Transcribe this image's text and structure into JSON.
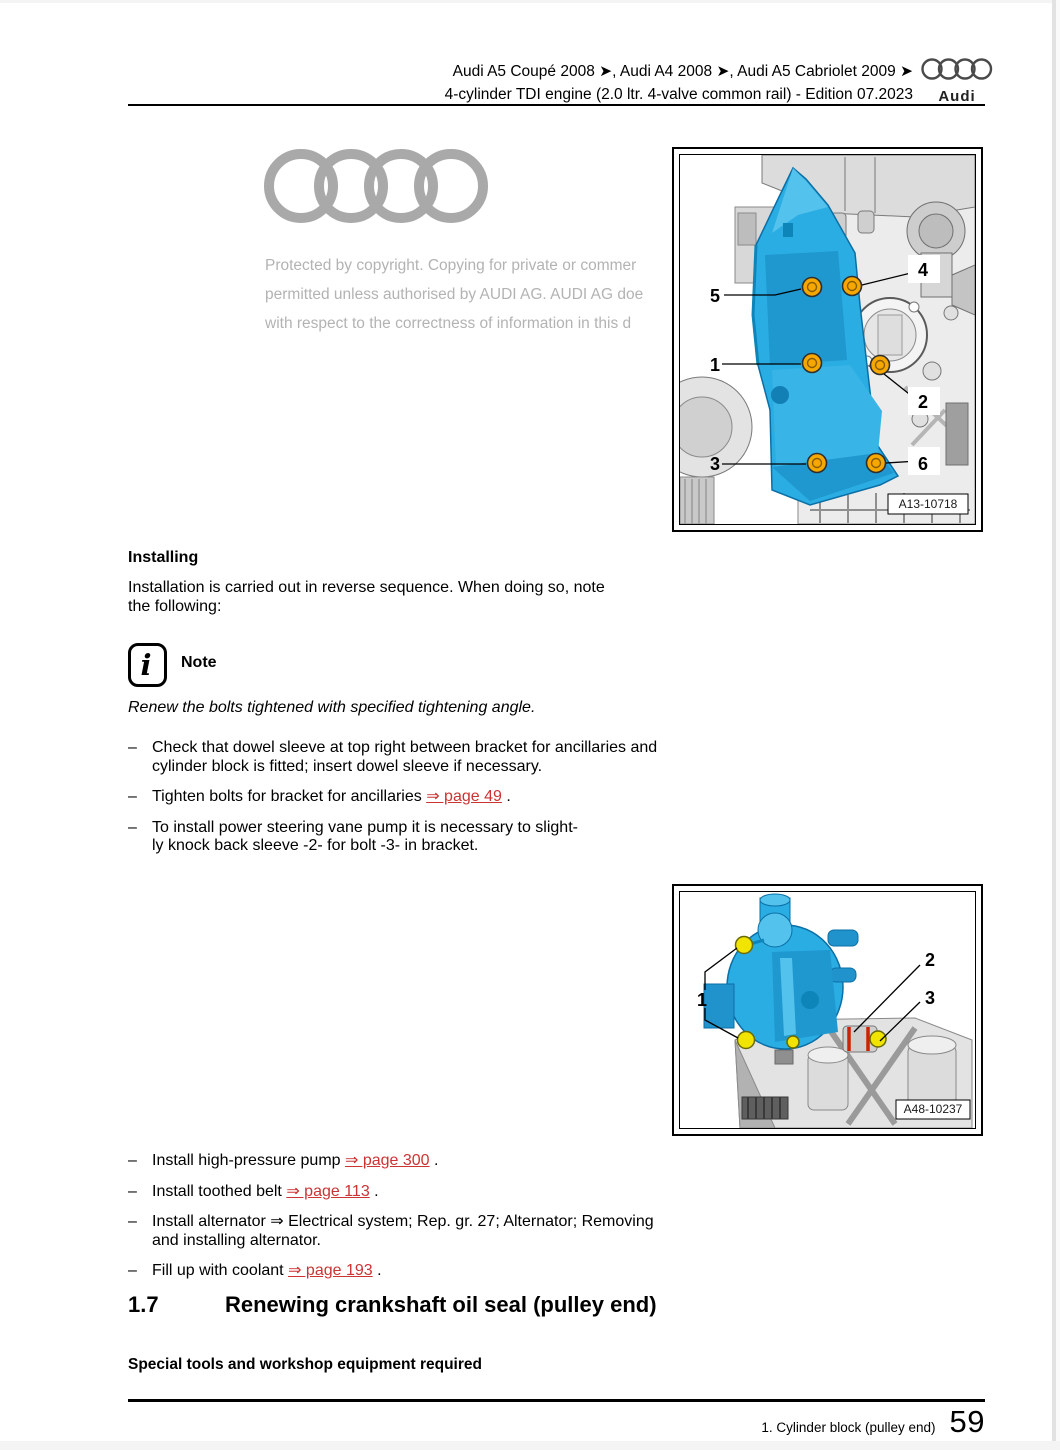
{
  "header": {
    "line1": "Audi A5 Coupé 2008 ➤, Audi A4 2008 ➤, Audi A5 Cabriolet 2009 ➤",
    "line2": "4-cylinder TDI engine (2.0 ltr. 4-valve common rail) - Edition 07.2023",
    "logo_wordmark": "Audi"
  },
  "watermark": {
    "line1": "Protected by copyright. Copying for private or commer",
    "line2": "permitted unless authorised by AUDI AG. AUDI AG doe",
    "line3": "with respect to the correctness of information in this d"
  },
  "figures": [
    {
      "id": "A13-10718",
      "callouts": [
        "1",
        "2",
        "3",
        "4",
        "5",
        "6"
      ]
    },
    {
      "id": "A48-10237",
      "callouts": [
        "1",
        "2",
        "3"
      ]
    }
  ],
  "glyphs": {
    "bullet": "–"
  },
  "content": {
    "installing_heading": "Installing",
    "installing_para": "Installation is carried out in reverse sequence. When doing so, note the following:",
    "note_icon_glyph": "i",
    "note_label": "Note",
    "note_italic": "Renew the bolts tightened with specified tightening angle.",
    "list1": [
      {
        "text": "Check that dowel sleeve at top right between bracket for ancillaries and cylinder block is fitted; insert dowel sleeve if necessary."
      },
      {
        "prefix": "Tighten bolts for bracket for ancillaries ",
        "link": "⇒ page 49",
        "suffix": " ."
      },
      {
        "line1": "To install power steering vane pump it is necessary to slight-",
        "line2": "ly knock back sleeve -2- for bolt -3- in bracket."
      }
    ],
    "list2": [
      {
        "prefix": "Install high-pressure pump ",
        "link": "⇒ page 300",
        "suffix": " ."
      },
      {
        "prefix": "Install toothed belt ",
        "link": "⇒ page 113",
        "suffix": " ."
      },
      {
        "text": "Install alternator ⇒ Electrical system; Rep. gr. 27; Alternator; Removing and installing alternator."
      },
      {
        "prefix": "Fill up with coolant ",
        "link": "⇒ page 193",
        "suffix": " ."
      }
    ],
    "section": {
      "number": "1.7",
      "title": "Renewing crankshaft oil seal (pulley end)"
    },
    "subheading": "Special tools and workshop equipment required"
  },
  "footer": {
    "chapter": "1. Cylinder block (pulley end)",
    "page_number": "59"
  },
  "colors": {
    "link_red": "#cc3333",
    "bracket_blue": "#2aade3",
    "bolt_orange": "#f6a800",
    "bolt_yellow": "#f0e400",
    "sleeve_red": "#cc2200",
    "watermark_gray": "#b3b3b3"
  }
}
